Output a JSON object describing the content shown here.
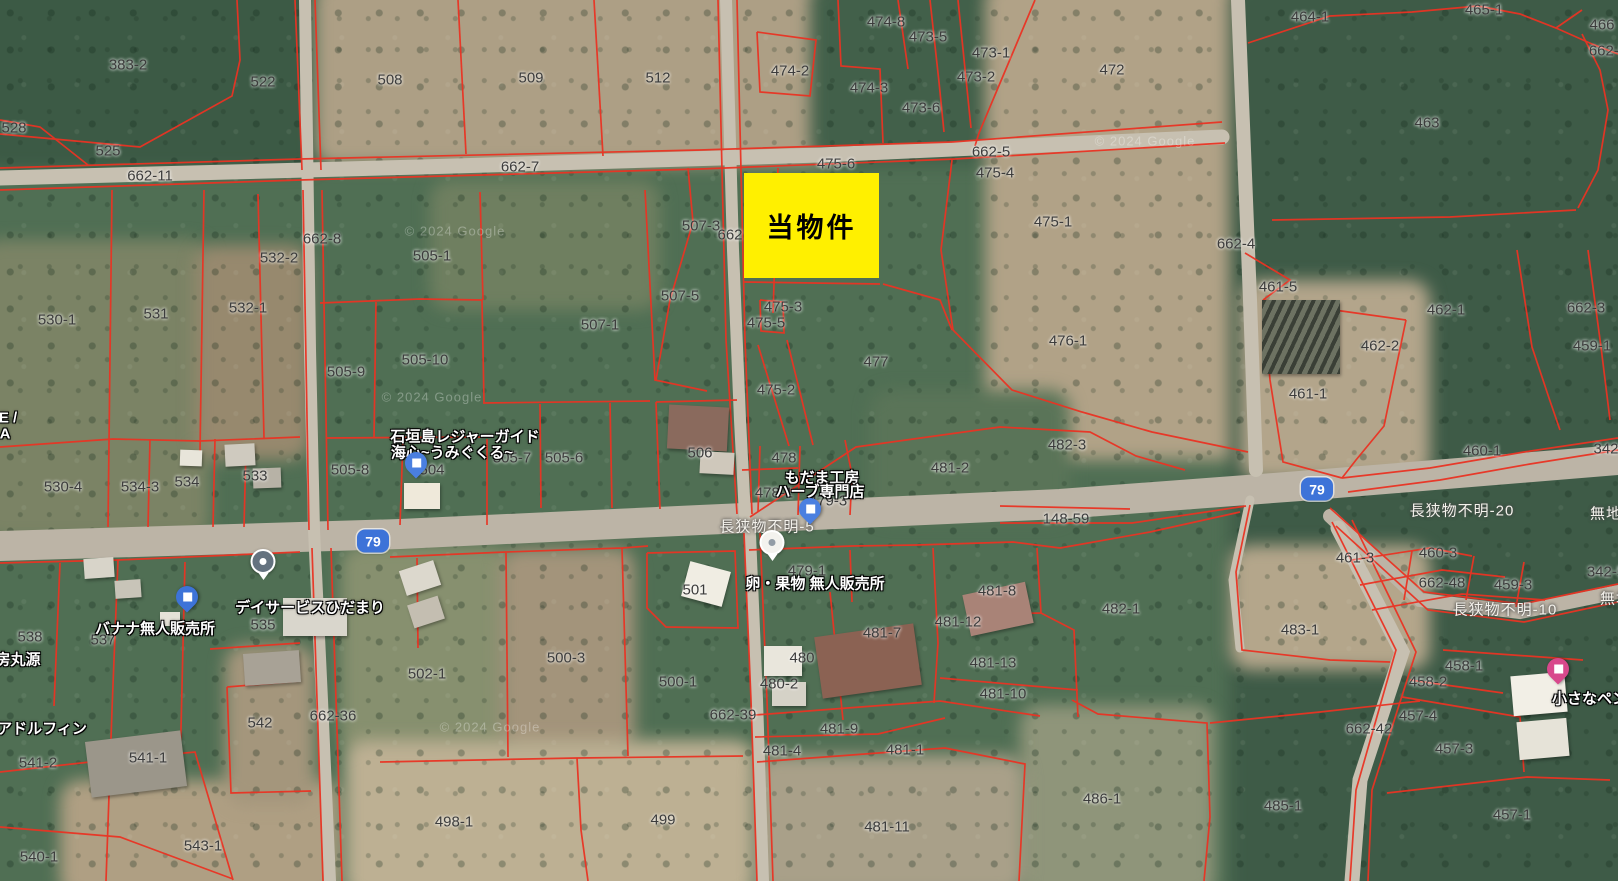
{
  "map": {
    "highlight": {
      "label": "当物件",
      "color": "#fff000",
      "x": 744,
      "y": 173,
      "w": 135,
      "h": 105
    },
    "colors": {
      "parcel_line": "#ea3323",
      "route_shield": "#3d73d8",
      "highlight": "#fff000"
    },
    "route_shields": [
      {
        "label": "79",
        "x": 373,
        "y": 541
      },
      {
        "label": "79",
        "x": 1317,
        "y": 489
      }
    ],
    "road_labels": [
      {
        "t": "長狭物不明-5",
        "x": 767,
        "y": 526
      },
      {
        "t": "長狭物不明-10",
        "x": 1505,
        "y": 609
      },
      {
        "t": "長狭物不明-20",
        "x": 1462,
        "y": 510
      },
      {
        "t": "無地",
        "x": 1606,
        "y": 513
      },
      {
        "t": "無地",
        "x": 1616,
        "y": 598
      }
    ],
    "poi_labels": [
      {
        "t": "石垣島レジャーガイド",
        "x": 465,
        "y": 436
      },
      {
        "t": "海心~うみぐくる~",
        "x": 452,
        "y": 452
      },
      {
        "t": "もだま工房",
        "x": 822,
        "y": 477
      },
      {
        "t": "ハーブ専門店",
        "x": 820,
        "y": 491
      },
      {
        "t": "卵・果物 無人販売所",
        "x": 815,
        "y": 583
      },
      {
        "t": "バナナ無人販売所",
        "x": 155,
        "y": 628
      },
      {
        "t": "デイサービスひだまり",
        "x": 310,
        "y": 607
      },
      {
        "t": "アドルフィン",
        "x": 42,
        "y": 728
      },
      {
        "t": "房丸源",
        "x": 18,
        "y": 659
      },
      {
        "t": "小さなペンション",
        "x": 1612,
        "y": 698
      },
      {
        "t": "E /",
        "x": 8,
        "y": 418
      },
      {
        "t": "A",
        "x": 5,
        "y": 434
      }
    ],
    "parcel_labels": [
      {
        "t": "383-2",
        "x": 128,
        "y": 65
      },
      {
        "t": "522",
        "x": 263,
        "y": 82
      },
      {
        "t": "508",
        "x": 390,
        "y": 80
      },
      {
        "t": "509",
        "x": 531,
        "y": 78
      },
      {
        "t": "512",
        "x": 658,
        "y": 78
      },
      {
        "t": "528",
        "x": 14,
        "y": 128
      },
      {
        "t": "525",
        "x": 108,
        "y": 151
      },
      {
        "t": "662-11",
        "x": 150,
        "y": 176
      },
      {
        "t": "662-7",
        "x": 520,
        "y": 167
      },
      {
        "t": "662-8",
        "x": 322,
        "y": 239
      },
      {
        "t": "474-8",
        "x": 886,
        "y": 22
      },
      {
        "t": "473-5",
        "x": 928,
        "y": 37
      },
      {
        "t": "473-1",
        "x": 991,
        "y": 53
      },
      {
        "t": "474-2",
        "x": 790,
        "y": 71
      },
      {
        "t": "473-2",
        "x": 976,
        "y": 77
      },
      {
        "t": "472",
        "x": 1112,
        "y": 70
      },
      {
        "t": "474-3",
        "x": 869,
        "y": 88
      },
      {
        "t": "473-6",
        "x": 921,
        "y": 108
      },
      {
        "t": "662-5",
        "x": 991,
        "y": 152
      },
      {
        "t": "475-6",
        "x": 836,
        "y": 164
      },
      {
        "t": "475-4",
        "x": 995,
        "y": 173
      },
      {
        "t": "475-1",
        "x": 1053,
        "y": 222
      },
      {
        "t": "464-1",
        "x": 1310,
        "y": 17
      },
      {
        "t": "465-1",
        "x": 1484,
        "y": 10
      },
      {
        "t": "466",
        "x": 1602,
        "y": 25
      },
      {
        "t": "662-5",
        "x": 1608,
        "y": 51
      },
      {
        "t": "463",
        "x": 1427,
        "y": 123
      },
      {
        "t": "662-4",
        "x": 1236,
        "y": 244
      },
      {
        "t": "532-2",
        "x": 279,
        "y": 258
      },
      {
        "t": "505-1",
        "x": 432,
        "y": 256
      },
      {
        "t": "530-1",
        "x": 57,
        "y": 320
      },
      {
        "t": "531",
        "x": 156,
        "y": 314
      },
      {
        "t": "532-1",
        "x": 248,
        "y": 308
      },
      {
        "t": "505-9",
        "x": 346,
        "y": 372
      },
      {
        "t": "505-10",
        "x": 425,
        "y": 360
      },
      {
        "t": "507-5",
        "x": 680,
        "y": 296
      },
      {
        "t": "507-1",
        "x": 600,
        "y": 325
      },
      {
        "t": "507-3",
        "x": 701,
        "y": 226
      },
      {
        "t": "662",
        "x": 730,
        "y": 235
      },
      {
        "t": "475-3",
        "x": 783,
        "y": 307
      },
      {
        "t": "475-5",
        "x": 766,
        "y": 323
      },
      {
        "t": "475-2",
        "x": 776,
        "y": 390
      },
      {
        "t": "477",
        "x": 876,
        "y": 362
      },
      {
        "t": "476-1",
        "x": 1068,
        "y": 341
      },
      {
        "t": "461-5",
        "x": 1278,
        "y": 287
      },
      {
        "t": "462-1",
        "x": 1446,
        "y": 310
      },
      {
        "t": "662-3",
        "x": 1586,
        "y": 308
      },
      {
        "t": "462-2",
        "x": 1380,
        "y": 346
      },
      {
        "t": "459-1",
        "x": 1592,
        "y": 346
      },
      {
        "t": "461-1",
        "x": 1308,
        "y": 394
      },
      {
        "t": "460-1",
        "x": 1482,
        "y": 451
      },
      {
        "t": "342",
        "x": 1606,
        "y": 449
      },
      {
        "t": "530-4",
        "x": 63,
        "y": 487
      },
      {
        "t": "534-3",
        "x": 140,
        "y": 487
      },
      {
        "t": "534",
        "x": 187,
        "y": 482
      },
      {
        "t": "533",
        "x": 255,
        "y": 476
      },
      {
        "t": "505-8",
        "x": 350,
        "y": 470
      },
      {
        "t": "505-7",
        "x": 512,
        "y": 458
      },
      {
        "t": "505-6",
        "x": 564,
        "y": 458
      },
      {
        "t": "504",
        "x": 432,
        "y": 470
      },
      {
        "t": "506",
        "x": 700,
        "y": 453
      },
      {
        "t": "478",
        "x": 784,
        "y": 458
      },
      {
        "t": "482-3",
        "x": 1067,
        "y": 445
      },
      {
        "t": "481-2",
        "x": 950,
        "y": 468
      },
      {
        "t": "478-1",
        "x": 774,
        "y": 493
      },
      {
        "t": "479-3",
        "x": 828,
        "y": 501
      },
      {
        "t": "148-59",
        "x": 1066,
        "y": 519
      },
      {
        "t": "460-3",
        "x": 1438,
        "y": 553
      },
      {
        "t": "461-3",
        "x": 1355,
        "y": 558
      },
      {
        "t": "662-48",
        "x": 1442,
        "y": 583
      },
      {
        "t": "459-3",
        "x": 1513,
        "y": 585
      },
      {
        "t": "342-5",
        "x": 1606,
        "y": 572
      },
      {
        "t": "479-1",
        "x": 807,
        "y": 571
      },
      {
        "t": "501",
        "x": 695,
        "y": 590
      },
      {
        "t": "481-8",
        "x": 997,
        "y": 591
      },
      {
        "t": "482-1",
        "x": 1121,
        "y": 609
      },
      {
        "t": "481-12",
        "x": 958,
        "y": 622
      },
      {
        "t": "481-7",
        "x": 882,
        "y": 633
      },
      {
        "t": "481-13",
        "x": 993,
        "y": 663
      },
      {
        "t": "483-1",
        "x": 1300,
        "y": 630
      },
      {
        "t": "480",
        "x": 802,
        "y": 658
      },
      {
        "t": "480-2",
        "x": 779,
        "y": 684
      },
      {
        "t": "481-10",
        "x": 1003,
        "y": 694
      },
      {
        "t": "500-3",
        "x": 566,
        "y": 658
      },
      {
        "t": "502-1",
        "x": 427,
        "y": 674
      },
      {
        "t": "500-1",
        "x": 678,
        "y": 682
      },
      {
        "t": "662-39",
        "x": 733,
        "y": 715
      },
      {
        "t": "662-36",
        "x": 333,
        "y": 716
      },
      {
        "t": "542",
        "x": 260,
        "y": 723
      },
      {
        "t": "541-2",
        "x": 38,
        "y": 763
      },
      {
        "t": "541-1",
        "x": 148,
        "y": 758
      },
      {
        "t": "543-1",
        "x": 203,
        "y": 846
      },
      {
        "t": "540-1",
        "x": 39,
        "y": 857
      },
      {
        "t": "498-1",
        "x": 454,
        "y": 822
      },
      {
        "t": "499",
        "x": 663,
        "y": 820
      },
      {
        "t": "481-9",
        "x": 839,
        "y": 729
      },
      {
        "t": "481-4",
        "x": 782,
        "y": 751
      },
      {
        "t": "481-1",
        "x": 905,
        "y": 750
      },
      {
        "t": "481-11",
        "x": 887,
        "y": 827
      },
      {
        "t": "486-1",
        "x": 1102,
        "y": 799
      },
      {
        "t": "485-1",
        "x": 1283,
        "y": 806
      },
      {
        "t": "458-1",
        "x": 1464,
        "y": 666
      },
      {
        "t": "458-2",
        "x": 1428,
        "y": 682
      },
      {
        "t": "457-4",
        "x": 1418,
        "y": 716
      },
      {
        "t": "662-42",
        "x": 1369,
        "y": 729
      },
      {
        "t": "457-3",
        "x": 1454,
        "y": 749
      },
      {
        "t": "457-1",
        "x": 1512,
        "y": 815
      },
      {
        "t": "537",
        "x": 103,
        "y": 640
      },
      {
        "t": "538",
        "x": 30,
        "y": 637
      },
      {
        "t": "535",
        "x": 263,
        "y": 625
      }
    ],
    "markers": [
      {
        "name": "leisure-guide-pin",
        "style": "drop",
        "body": "#4a7fe0",
        "dot": "#ffffff",
        "x": 416,
        "y": 474
      },
      {
        "name": "banana-stand-pin",
        "style": "drop",
        "body": "#3d73d8",
        "dot": "#ffffff",
        "x": 187,
        "y": 608
      },
      {
        "name": "dayservice-pin",
        "style": "round",
        "body": "#64727f",
        "dot": "#ffffff",
        "x": 263,
        "y": 585
      },
      {
        "name": "herb-shop-pin",
        "style": "drop",
        "body": "#4a7fe0",
        "dot": "#ffffff",
        "x": 810,
        "y": 520
      },
      {
        "name": "egg-fruit-stand-pin",
        "style": "round",
        "body": "#f3f2ee",
        "dot": "#929ca6",
        "x": 772,
        "y": 566
      },
      {
        "name": "pension-pin",
        "style": "drop",
        "body": "#d8488c",
        "dot": "#ffffff",
        "x": 1558,
        "y": 680
      }
    ],
    "watermarks": [
      {
        "t": "© 2024 Google",
        "x": 455,
        "y": 231
      },
      {
        "t": "© 2024 Google",
        "x": 490,
        "y": 727
      },
      {
        "t": "© 2024 Google",
        "x": 1145,
        "y": 141
      },
      {
        "t": "© 2024 Google",
        "x": 432,
        "y": 397
      }
    ]
  }
}
